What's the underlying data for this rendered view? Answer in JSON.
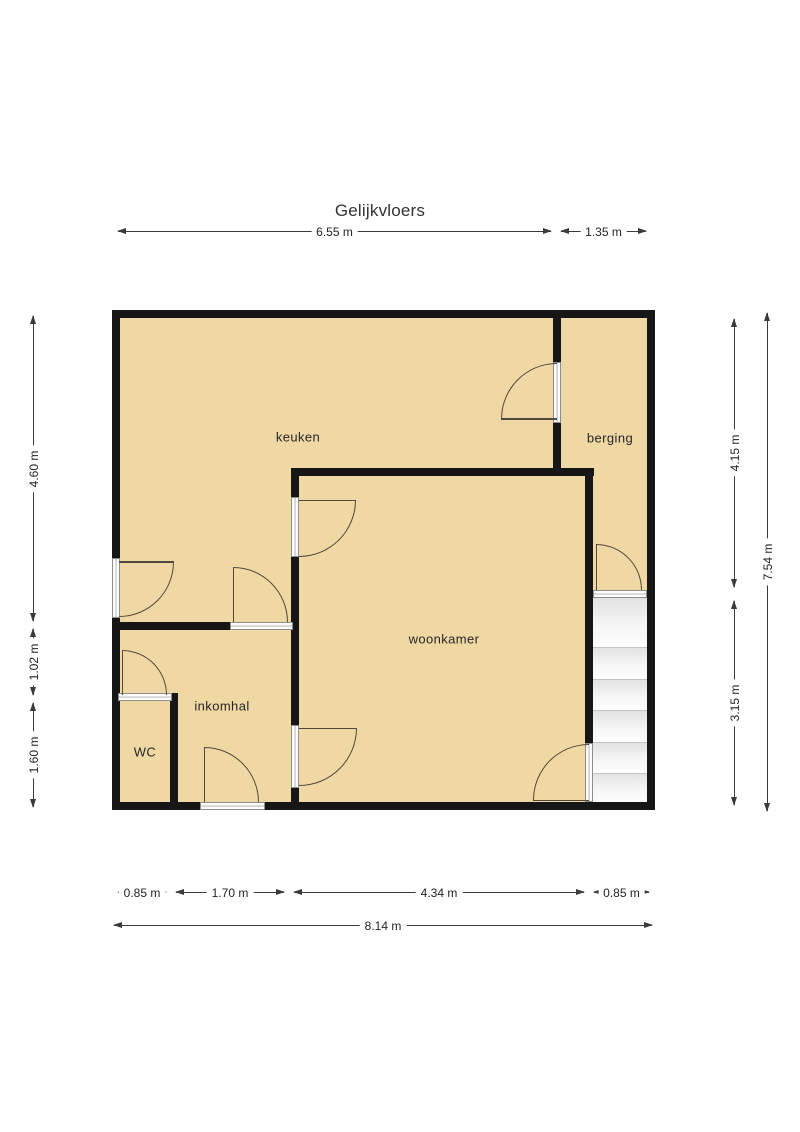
{
  "title": "Gelijkvloers",
  "rooms": {
    "keuken": {
      "label": "keuken"
    },
    "berging": {
      "label": "berging"
    },
    "woonkamer": {
      "label": "woonkamer"
    },
    "inkomhal": {
      "label": "inkomhal"
    },
    "wc": {
      "label": "WC"
    }
  },
  "dimensions": {
    "top": [
      {
        "label": "6.55 m"
      },
      {
        "label": "1.35 m"
      }
    ],
    "bottom_segments": [
      {
        "label": "0.85 m"
      },
      {
        "label": "1.70 m"
      },
      {
        "label": "4.34 m"
      },
      {
        "label": "0.85 m"
      }
    ],
    "bottom_total": {
      "label": "8.14 m"
    },
    "left": [
      {
        "label": "4.60 m"
      },
      {
        "label": "1.02 m"
      },
      {
        "label": "1.60 m"
      }
    ],
    "right": [
      {
        "label": "4.15 m"
      },
      {
        "label": "3.15 m"
      }
    ],
    "right_total": {
      "label": "7.54 m"
    }
  },
  "colors": {
    "floor": "#f0d8a4",
    "wall": "#161616",
    "door_line": "#53493b",
    "dimension_line": "#3a3a3a",
    "stairs": "#fafafa",
    "background": "#ffffff"
  }
}
